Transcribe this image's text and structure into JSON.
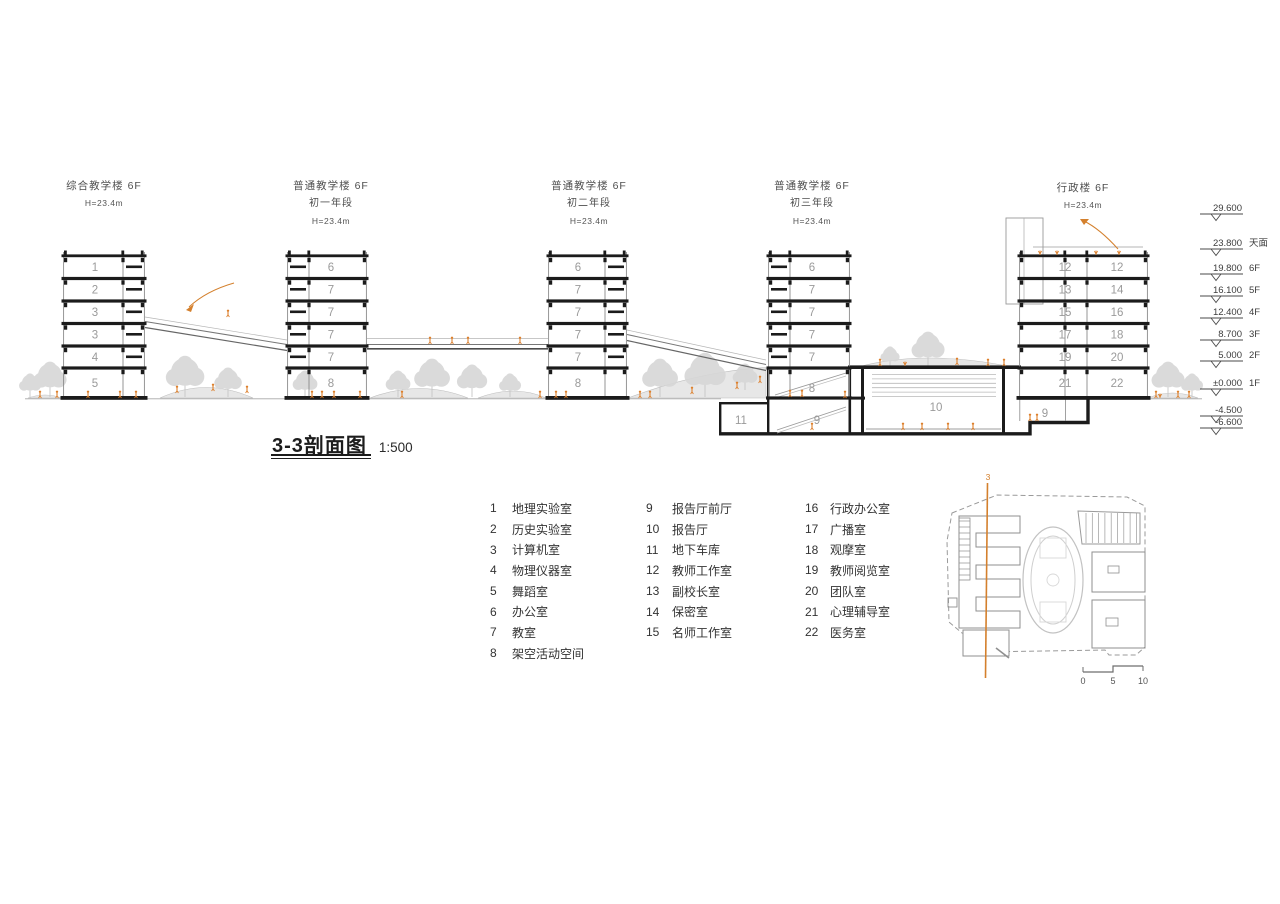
{
  "section": {
    "title": "3-3剖面图",
    "scale": "1:500",
    "buildings": [
      {
        "name": "综合教学楼 6F",
        "grade": "",
        "height": "H=23.4m",
        "floors": [
          "1",
          "2",
          "3",
          "3",
          "4",
          "5"
        ],
        "x": 63,
        "w": 82,
        "corridor": "right",
        "label_cx": 95,
        "header_cx": 104,
        "header_y": 177
      },
      {
        "name": "普通教学楼 6F",
        "grade": "初一年段",
        "height": "H=23.4m",
        "floors": [
          "6",
          "7",
          "7",
          "7",
          "7",
          "8"
        ],
        "x": 287,
        "w": 80,
        "corridor": "left",
        "label_cx": 331,
        "header_cx": 331,
        "header_y": 177
      },
      {
        "name": "普通教学楼 6F",
        "grade": "初二年段",
        "height": "H=23.4m",
        "floors": [
          "6",
          "7",
          "7",
          "7",
          "7",
          "8"
        ],
        "x": 548,
        "w": 79,
        "corridor": "right",
        "label_cx": 578,
        "header_cx": 589,
        "header_y": 177
      },
      {
        "name": "普通教学楼 6F",
        "grade": "初三年段",
        "height": "H=23.4m",
        "floors": [
          "6",
          "7",
          "7",
          "7",
          "7"
        ],
        "x": 768,
        "w": 82,
        "corridor": "left",
        "label_cx": 812,
        "header_cx": 812,
        "header_y": 177,
        "short": true
      },
      {
        "name": "行政楼 6F",
        "grade": "",
        "height": "H=23.4m",
        "floor_pairs": [
          [
            "12",
            "12"
          ],
          [
            "13",
            "14"
          ],
          [
            "15",
            "16"
          ],
          [
            "17",
            "18"
          ],
          [
            "19",
            "20"
          ],
          [
            "21",
            "22"
          ]
        ],
        "x": 1019,
        "w": 129,
        "corridor": "center",
        "header_cx": 1083,
        "header_y": 179
      }
    ],
    "room_labels": [
      {
        "num": "8",
        "x": 812,
        "y": 392
      },
      {
        "num": "9",
        "x": 817,
        "y": 424
      },
      {
        "num": "10",
        "x": 936,
        "y": 411
      },
      {
        "num": "9",
        "x": 1045,
        "y": 417
      },
      {
        "num": "11",
        "x": 741,
        "y": 424
      }
    ],
    "elevations": [
      {
        "value": "29.600",
        "floor": "",
        "y": 210
      },
      {
        "value": "23.800",
        "floor": "天面",
        "y": 245
      },
      {
        "value": "19.800",
        "floor": "6F",
        "y": 270
      },
      {
        "value": "16.100",
        "floor": "5F",
        "y": 292
      },
      {
        "value": "12.400",
        "floor": "4F",
        "y": 314
      },
      {
        "value": "8.700",
        "floor": "3F",
        "y": 336
      },
      {
        "value": "5.000",
        "floor": "2F",
        "y": 357
      },
      {
        "value": "±0.000",
        "floor": "1F",
        "y": 385
      },
      {
        "value": "-4.500",
        "floor": "",
        "y": 412
      },
      {
        "value": "-6.600",
        "floor": "",
        "y": 424
      }
    ]
  },
  "legend": {
    "columns": [
      [
        {
          "num": "1",
          "label": "地理实验室"
        },
        {
          "num": "2",
          "label": "历史实验室"
        },
        {
          "num": "3",
          "label": "计算机室"
        },
        {
          "num": "4",
          "label": "物理仪器室"
        },
        {
          "num": "5",
          "label": "舞蹈室"
        },
        {
          "num": "6",
          "label": "办公室"
        },
        {
          "num": "7",
          "label": "教室"
        },
        {
          "num": "8",
          "label": "架空活动空间"
        }
      ],
      [
        {
          "num": "9",
          "label": "报告厅前厅"
        },
        {
          "num": "10",
          "label": "报告厅"
        },
        {
          "num": "11",
          "label": "地下车库"
        },
        {
          "num": "12",
          "label": "教师工作室"
        },
        {
          "num": "13",
          "label": "副校长室"
        },
        {
          "num": "14",
          "label": "保密室"
        },
        {
          "num": "15",
          "label": "名师工作室"
        }
      ],
      [
        {
          "num": "16",
          "label": "行政办公室"
        },
        {
          "num": "17",
          "label": "广播室"
        },
        {
          "num": "18",
          "label": "观摩室"
        },
        {
          "num": "19",
          "label": "教师阅览室"
        },
        {
          "num": "20",
          "label": "团队室"
        },
        {
          "num": "21",
          "label": "心理辅导室"
        },
        {
          "num": "22",
          "label": "医务室"
        }
      ]
    ]
  },
  "site_plan": {
    "section_label": "3",
    "scale_labels": [
      "0",
      "5",
      "10"
    ]
  },
  "colors": {
    "structure": "#1b1b1b",
    "wall": "#8a8a8a",
    "tree": "#d7d7d7",
    "mound": "#d0d0d0",
    "figure": "#dd7f2b",
    "accent": "#d4802d",
    "text_gray": "#9a9a9a",
    "text_dark": "#3c3c3c"
  }
}
